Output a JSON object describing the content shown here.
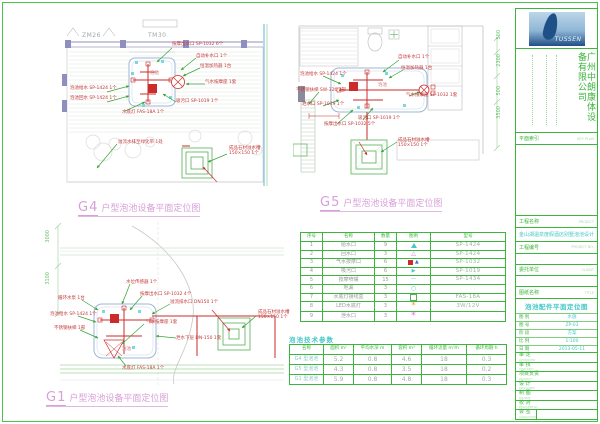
{
  "sheet": {
    "bg": "#ffffff",
    "frame_color": "#3cb53c"
  },
  "plans": {
    "g4": {
      "code": "G4",
      "title": "户型泡池设备平面定位图",
      "wall_label_left": "ZM26",
      "wall_label_right": "TM30",
      "pool_label": "泡池",
      "annotations": [
        "泡池给水 SP-1424 1个",
        "泡池回水 SP-1424 1个",
        "自动补水口 1个",
        "恒温加热器 1台",
        "气水按摩座 1套",
        "按摩出水口 SP-1032 6个",
        "吸污口 SP-1019 1个",
        "水底灯 FAS-18A 1个",
        "溢流水排至绿化带 1处",
        "成品石材溢水槽 150×150 1个"
      ]
    },
    "g5": {
      "code": "G5",
      "title": "户型泡池设备平面定位图",
      "pool_label": "泡池",
      "dims": [
        "500",
        "2300",
        "500",
        "3500"
      ],
      "annotations": [
        "泡池给水 SP-1424 1个",
        "不锈钢扶梯 SW-326 1部",
        "泄水口 SP-1019 1个",
        "自动补水口 1个",
        "恒温加热器 1台",
        "气水按摩座 SP-1032 1套",
        "按摩出水口 SP-1032 5个",
        "吸污口 SP-1019 1个",
        "成品石材溢水槽 150×150 1个"
      ]
    },
    "g1": {
      "code": "G1",
      "title": "户型泡池设备平面定位图",
      "pool_label": "泡池",
      "dims": [
        "3000",
        "3100"
      ],
      "annotations": [
        "循环水泵 1台",
        "泡池给水 SP-1424 1个",
        "不锈钢扶梯 1部",
        "水位传感器 1个",
        "按摩出水口 SP-1032 4个",
        "溢流排水口 DN150 1个",
        "泄水下层 DN-150 1套",
        "气水按摩座 1套",
        "水底灯 FAS-18A 1个",
        "成品石材溢水槽 150×150 1个"
      ]
    }
  },
  "equipment_table": {
    "headers": [
      "序号",
      "名称",
      "数量",
      "图例",
      "型号"
    ],
    "rows": [
      {
        "no": "1",
        "name": "给水口",
        "qty": "9",
        "legend": "cyan-filled-triangle",
        "model": "SP-1424"
      },
      {
        "no": "2",
        "name": "回水口",
        "qty": "3",
        "legend": "magenta-triangle",
        "model": "SP-1424"
      },
      {
        "no": "3",
        "name": "气水按摩口",
        "qty": "6",
        "legend": "red-square-blue-triangle",
        "model": "SP-1032"
      },
      {
        "no": "4",
        "name": "吸污口",
        "qty": "6",
        "legend": "cyan-flag",
        "model": "SP-1019"
      },
      {
        "no": "5",
        "name": "按摩喷嘴",
        "qty": "15",
        "legend": "cyan-dash",
        "model": "SP-1434"
      },
      {
        "no": "6",
        "name": "地漏",
        "qty": "3",
        "legend": "cyan-circle",
        "model": ""
      },
      {
        "no": "7",
        "name": "水底灯接线盒",
        "qty": "3",
        "legend": "green-square",
        "model": "FAS-18A"
      },
      {
        "no": "8",
        "name": "LED水底灯",
        "qty": "3",
        "legend": "orange-star",
        "model": "3W/12V"
      },
      {
        "no": "9",
        "name": "泄水口",
        "qty": "3",
        "legend": "magenta-star",
        "model": ""
      }
    ]
  },
  "params_table": {
    "title": "泡池技术参数",
    "headers": [
      "名称",
      "面积 m²",
      "平均水深 m",
      "容积 m³",
      "循环流量 m³/h",
      "循环周期 h"
    ],
    "rows": [
      [
        "G4 型泡池",
        "5.2",
        "0.8",
        "4.6",
        "18",
        "0.3"
      ],
      [
        "G5 型泡池",
        "4.3",
        "0.8",
        "3.5",
        "18",
        "0.2"
      ],
      [
        "G1 型泡池",
        "5.9",
        "0.8",
        "4.8",
        "18",
        "0.3"
      ]
    ]
  },
  "title_block": {
    "logo_text": "TUSSEN",
    "company": "广州中朗康体设备有限公司",
    "key_plan_label": "平面索引",
    "key_plan_sub": "KEY PLAN",
    "project_label": "工程名称",
    "project_sub": "PROJECT",
    "project_name": "金山湖温泉度假酒店别墅泡池设计",
    "project_no_label": "工程编号",
    "project_no_sub": "PROJECT NO.",
    "client_label": "委托单位",
    "client_sub": "CLIENT",
    "title_label": "图纸名称",
    "title_sub": "TITLE",
    "drawing_title": "泡池配件平面定位图",
    "fields": [
      {
        "label": "图 别",
        "value": "水施"
      },
      {
        "label": "图 号",
        "value": "ZP-03"
      },
      {
        "label": "阶 段",
        "value": "方案"
      },
      {
        "label": "比 例",
        "value": "1:100"
      },
      {
        "label": "日 期",
        "value": "2013-05-11"
      }
    ],
    "signatures": [
      {
        "label": "审 定",
        "sub": "APPROVED"
      },
      {
        "label": "审 核",
        "sub": "CHECKED"
      },
      {
        "label": "项目负责",
        "sub": "PROJECT"
      },
      {
        "label": "设 计",
        "sub": "DESIGNED"
      },
      {
        "label": "制 图",
        "sub": "DRAWN"
      },
      {
        "label": "校 对",
        "sub": "PROOFREAD"
      },
      {
        "label": "会 签",
        "sub": "SIGNATURE"
      }
    ]
  }
}
